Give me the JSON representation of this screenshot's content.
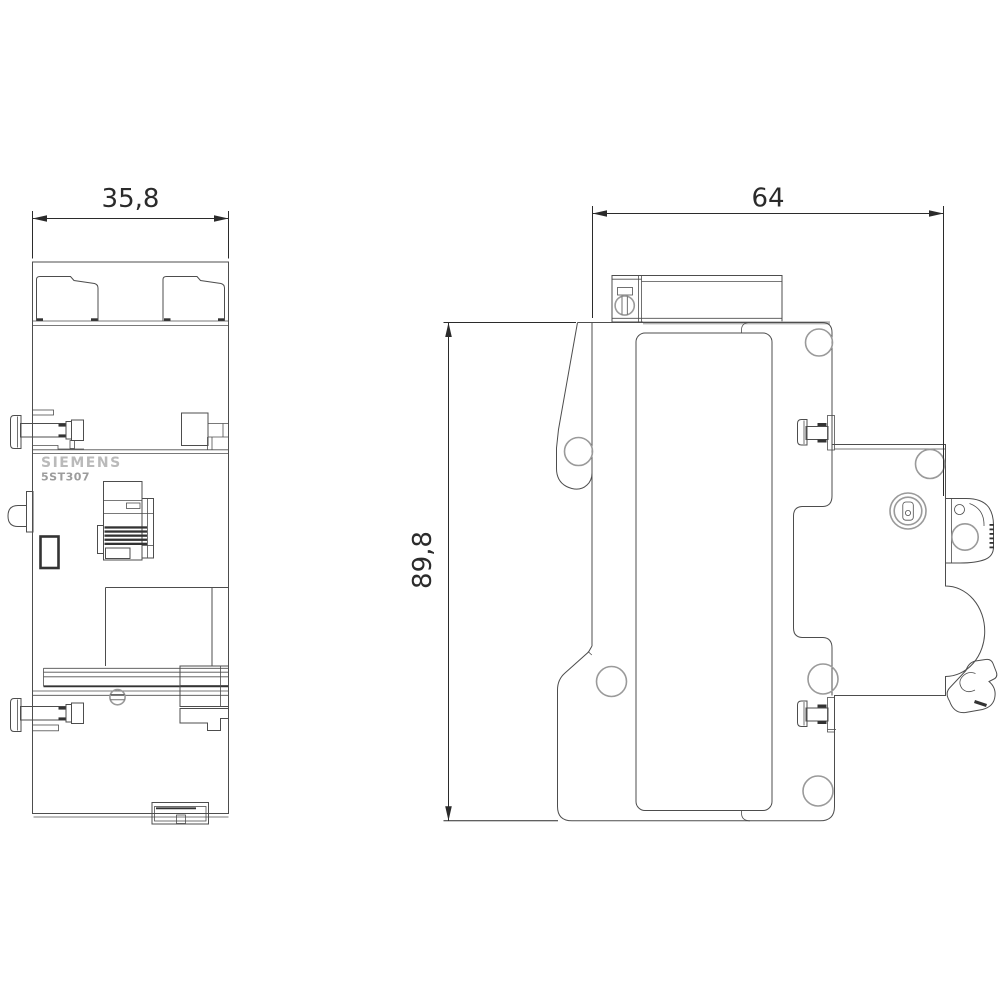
{
  "product": {
    "brand": "SIEMENS",
    "model": "5ST307"
  },
  "dimensions": {
    "front_width": "35,8",
    "side_width": "64",
    "side_height": "89,8"
  },
  "colors": {
    "background": "#ffffff",
    "line": "#4d4d4d",
    "dim": "#2b2b2b",
    "gray_circle": "#9a9a9a",
    "brand_text": "#bababa",
    "model_text": "#9c9c9c",
    "dark_detail": "#333333",
    "shadow_line": "#b5b5b5"
  }
}
